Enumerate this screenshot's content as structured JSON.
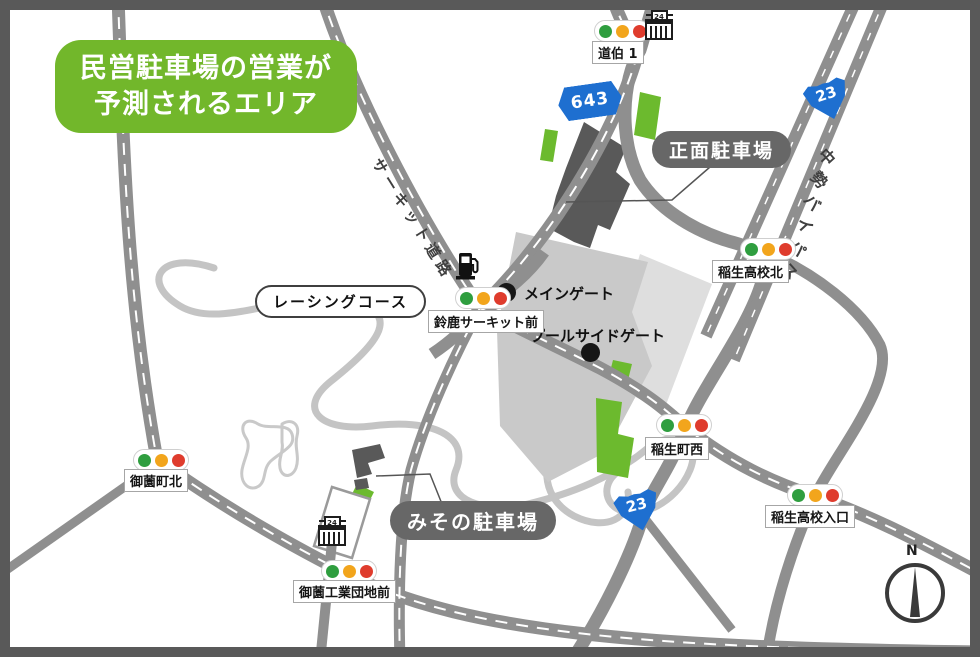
{
  "map": {
    "banner": {
      "line1": "民営駐車場の営業が",
      "line2": "予測されるエリア"
    },
    "parking_labels": {
      "front": "正面駐車場",
      "misono": "みその駐車場"
    },
    "course_label": "レーシングコース",
    "road_names": {
      "circuit_road": "サーキット道路",
      "chusei_bypass": "中勢バイパス"
    },
    "shields": {
      "r643": "643",
      "r23_top": "23",
      "r23_south": "23"
    },
    "signals": [
      {
        "name": "dohaku-1",
        "label": "道伯 1"
      },
      {
        "name": "inou-koko-kita",
        "label": "稲生高校北"
      },
      {
        "name": "suzuka-circuit-mae",
        "label": "鈴鹿サーキット前"
      },
      {
        "name": "inou-cho-nishi",
        "label": "稲生町西"
      },
      {
        "name": "inou-koko-iriguchi",
        "label": "稲生高校入口"
      },
      {
        "name": "misono-cho-kita",
        "label": "御薗町北"
      },
      {
        "name": "misono-kogyo-danchi-mae",
        "label": "御薗工業団地前"
      }
    ],
    "gates": {
      "main": "メインゲート",
      "poolside": "プールサイドゲート"
    },
    "compass_label": "N",
    "icons": {
      "convenience_badge": "24"
    },
    "colors": {
      "banner_green": "#72b72b",
      "parking_area_green": "#6cba2e",
      "road_gray": "#8f8f8f",
      "frame_dark_gray": "#595959",
      "circuit_area_gray": "#c9c9c9",
      "circuit_area_light_gray": "#dedede",
      "course_gray": "#c4c4c4",
      "route_shield_blue": "#1e6fd0",
      "signal_green": "#2f9e3f",
      "signal_yellow": "#f2a51c",
      "signal_red": "#df3c2d",
      "parking_pill_gray": "#676767"
    }
  }
}
